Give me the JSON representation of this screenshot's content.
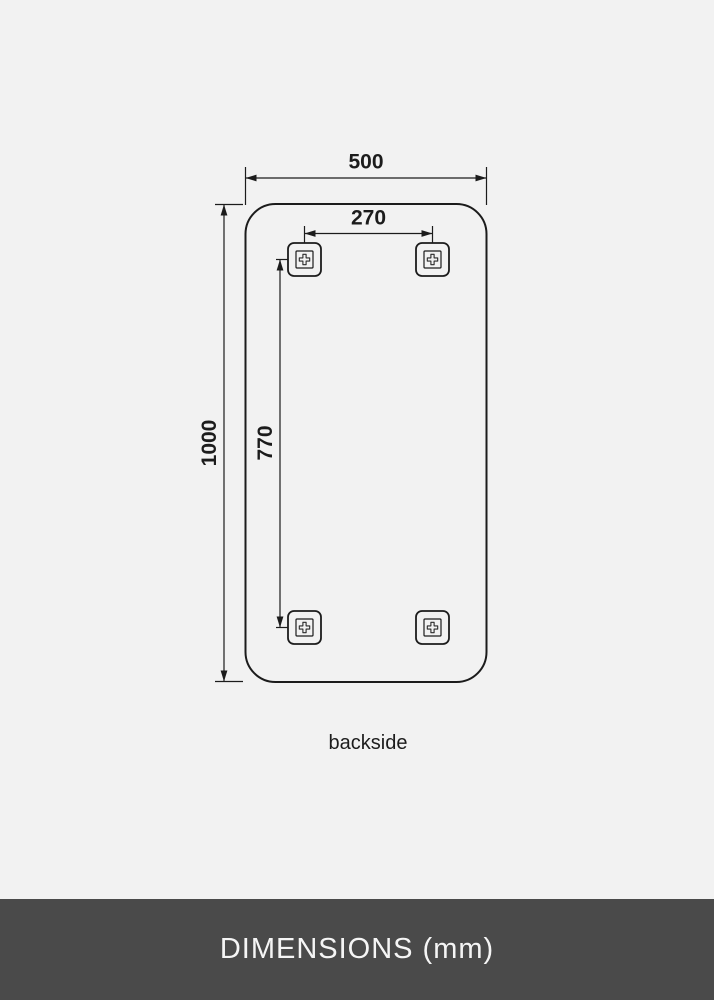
{
  "diagram": {
    "caption": "backside",
    "dims": {
      "outer_width_mm": "500",
      "outer_height_mm": "1000",
      "hole_spacing_width_mm": "270",
      "hole_spacing_height_mm": "770"
    },
    "bracket_count": 4
  },
  "footer": {
    "title": "DIMENSIONS (mm)"
  },
  "colors": {
    "page_background": "#f2f2f2",
    "line": "#1c1c1c",
    "footer_background": "#4a4a4a",
    "footer_text": "#f5f5f5"
  }
}
